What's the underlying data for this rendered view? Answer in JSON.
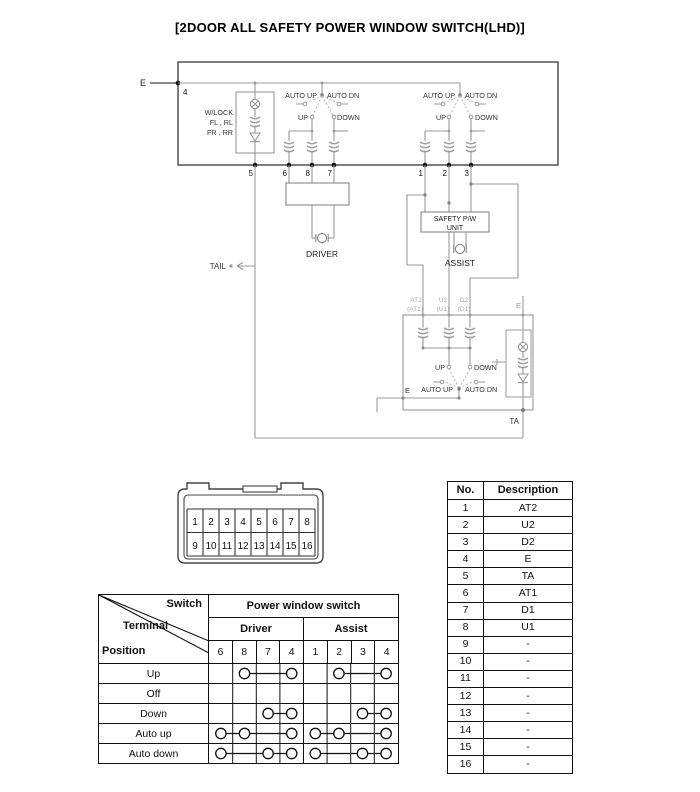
{
  "title": "[2DOOR ALL SAFETY POWER WINDOW SWITCH(LHD)]",
  "schematic": {
    "e_top": "E",
    "pin4": "4",
    "wlock": [
      "W/LOCK",
      "FL , RL",
      "FR , RR"
    ],
    "sw_driver": {
      "auto_up": "AUTO UP",
      "auto_dn": "AUTO DN",
      "up": "UP",
      "down": "DOWN"
    },
    "sw_assist": {
      "auto_up": "AUTO UP",
      "auto_dn": "AUTO DN",
      "up": "UP",
      "down": "DOWN"
    },
    "sw_lower": {
      "auto_up": "AUTO UP",
      "auto_dn": "AUTO DN",
      "up": "UP",
      "down": "DOWN"
    },
    "pins": [
      "5",
      "6",
      "8",
      "7",
      "1",
      "2",
      "3"
    ],
    "driver_motor": "DRIVER",
    "tail": "TAIL",
    "safety_unit": [
      "SAFETY P/W",
      "UNIT"
    ],
    "assist_motor": "ASSIST",
    "lower_labels": {
      "at2": "AT2",
      "at1": "(AT1)",
      "u2": "U2",
      "u1": "(U1)",
      "d2": "D2",
      "d1": "(D1)"
    },
    "e_right": "E",
    "e_lower": "E",
    "ta": "TA"
  },
  "connector": {
    "row1": [
      "1",
      "2",
      "3",
      "4",
      "5",
      "6",
      "7",
      "8"
    ],
    "row2": [
      "9",
      "10",
      "11",
      "12",
      "13",
      "14",
      "15",
      "16"
    ]
  },
  "desc_table": {
    "headers": [
      "No.",
      "Description"
    ],
    "rows": [
      {
        "no": "1",
        "desc": "AT2"
      },
      {
        "no": "2",
        "desc": "U2"
      },
      {
        "no": "3",
        "desc": "D2"
      },
      {
        "no": "4",
        "desc": "E"
      },
      {
        "no": "5",
        "desc": "TA"
      },
      {
        "no": "6",
        "desc": "AT1"
      },
      {
        "no": "7",
        "desc": "D1"
      },
      {
        "no": "8",
        "desc": "U1"
      },
      {
        "no": "9",
        "desc": "-"
      },
      {
        "no": "10",
        "desc": "-"
      },
      {
        "no": "11",
        "desc": "-"
      },
      {
        "no": "12",
        "desc": "-"
      },
      {
        "no": "13",
        "desc": "-"
      },
      {
        "no": "14",
        "desc": "-"
      },
      {
        "no": "15",
        "desc": "-"
      },
      {
        "no": "16",
        "desc": "-"
      }
    ]
  },
  "switch_table": {
    "corner": {
      "switch": "Switch",
      "terminal": "Terminal",
      "position": "Position"
    },
    "group_header": "Power window switch",
    "sub_headers": [
      "Driver",
      "Assist"
    ],
    "terminals": [
      "6",
      "8",
      "7",
      "4",
      "1",
      "2",
      "3",
      "4"
    ],
    "rows": [
      {
        "label": "Up",
        "circles": [
          2,
          4,
          6,
          8
        ],
        "lines": [
          [
            2,
            4
          ],
          [
            6,
            8
          ]
        ]
      },
      {
        "label": "Off",
        "circles": [],
        "lines": []
      },
      {
        "label": "Down",
        "circles": [
          3,
          4,
          7,
          8
        ],
        "lines": [
          [
            3,
            4
          ],
          [
            7,
            8
          ]
        ]
      },
      {
        "label": "Auto up",
        "circles": [
          1,
          2,
          4,
          5,
          6,
          8
        ],
        "lines": [
          [
            1,
            4
          ],
          [
            5,
            8
          ]
        ]
      },
      {
        "label": "Auto down",
        "circles": [
          1,
          3,
          4,
          5,
          7,
          8
        ],
        "lines": [
          [
            1,
            4
          ],
          [
            5,
            8
          ]
        ]
      }
    ]
  }
}
